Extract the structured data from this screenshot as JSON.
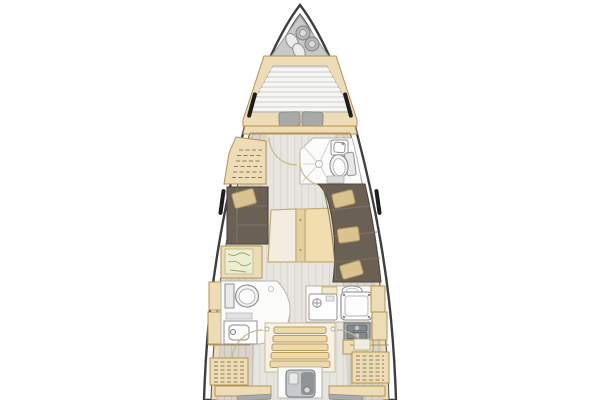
{
  "diagram": {
    "type": "sailing-yacht-interior-floorplan",
    "orientation": "bow-up",
    "areas": [
      "anchor-locker",
      "v-berth-cabin",
      "forward-head",
      "wardrobe",
      "salon",
      "nav-station",
      "galley",
      "aft-head",
      "companionway",
      "engine-bay",
      "aft-lockers",
      "aft-cabins"
    ]
  },
  "colors": {
    "hull_outline": "#3e3e3e",
    "hull_inner_line": "#5a5a5a",
    "deck": "#eddcb5",
    "trim": "#b5924f",
    "floor": "#d9d5cd",
    "floor_line": "#c7c2b7",
    "locker_gray": "#c8c8c6",
    "mattress_base": "#e2e2e0",
    "slat_light": "#f6f6f5",
    "pillow_gray": "#a9a9a9",
    "pillow_tan": "#d9c391",
    "pillow_tan_line": "#b99d62",
    "sofa": "#6b6054",
    "sofa_line": "#7e7366",
    "sofa_edge": "#4f463c",
    "white_floor": "#fcfcfb",
    "fixture_line": "#8f8f8f",
    "fixture_fill": "#f4f4f4",
    "appliance": "#a7acb0",
    "appliance_dark": "#83888c",
    "appliance_edge": "#5f6468",
    "chart": "#ebefd2",
    "chart_line": "#9aa75e",
    "door_arc": "#c8b78d",
    "window_mark": "#1e1e1e"
  }
}
